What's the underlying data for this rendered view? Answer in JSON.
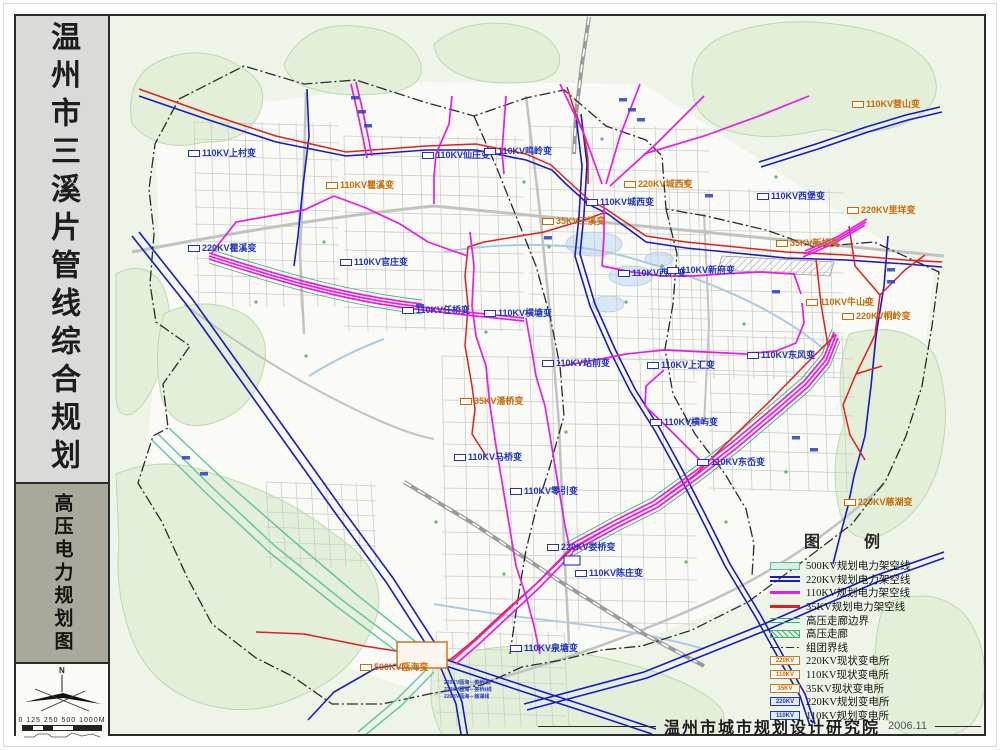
{
  "sidebar": {
    "main_title": "温州市三溪片管线综合规划",
    "sub_title": "高压电力规划图",
    "compass_label": "N",
    "scale_text": "0 125 250 500    1000M"
  },
  "legend": {
    "title": "图　例",
    "items": [
      {
        "label": "500KV规划电力架空线",
        "swatch": "band500"
      },
      {
        "label": "220KV规划电力架空线",
        "swatch": "line220"
      },
      {
        "label": "110KV规划电力架空线",
        "swatch": "line110"
      },
      {
        "label": "35KV规划电力架空线",
        "swatch": "line35"
      },
      {
        "label": "高压走廊边界",
        "swatch": "corridor-edge"
      },
      {
        "label": "高压走廊",
        "swatch": "corridor"
      },
      {
        "label": "组团界线",
        "swatch": "cluster-boundary"
      },
      {
        "label": "220KV现状变电所",
        "swatch": "box-existing",
        "box_text": "220KV"
      },
      {
        "label": "110KV现状变电所",
        "swatch": "box-existing",
        "box_text": "110KV"
      },
      {
        "label": "35KV现状变电所",
        "swatch": "box-existing",
        "box_text": "35KV"
      },
      {
        "label": "220KV规划变电所",
        "swatch": "box-planned",
        "box_text": "220KV"
      },
      {
        "label": "110KV规划变电所",
        "swatch": "box-planned",
        "box_text": "110KV"
      }
    ]
  },
  "footer": {
    "org": "温州市城市规划设计研究院",
    "date": "2006.11"
  },
  "colors": {
    "kv500": "#63c7a4",
    "kv220": "#1a1ac8",
    "kv110": "#e81ce8",
    "kv35": "#e02020",
    "corridor_edge": "#3bb26d",
    "existing_text": "#cc6600",
    "planned_text": "#2134c4"
  },
  "map": {
    "substations": [
      {
        "label": "110KV瞿溪变",
        "x": 322,
        "y": 180,
        "type": "existing"
      },
      {
        "label": "35KV三溪变",
        "x": 538,
        "y": 216,
        "type": "existing"
      },
      {
        "label": "220KV城西变",
        "x": 620,
        "y": 179,
        "type": "existing"
      },
      {
        "label": "110KV营山变",
        "x": 848,
        "y": 99,
        "type": "existing"
      },
      {
        "label": "220KV里垟变",
        "x": 843,
        "y": 205,
        "type": "existing"
      },
      {
        "label": "35KV新桥变",
        "x": 772,
        "y": 238,
        "type": "existing"
      },
      {
        "label": "110KV牛山变",
        "x": 802,
        "y": 297,
        "type": "existing"
      },
      {
        "label": "220KV桐岭变",
        "x": 838,
        "y": 311,
        "type": "existing"
      },
      {
        "label": "35KV潘桥变",
        "x": 456,
        "y": 396,
        "type": "existing"
      },
      {
        "label": "220KV慈湖变",
        "x": 840,
        "y": 497,
        "type": "existing"
      },
      {
        "label": "500KV瓯海变",
        "x": 356,
        "y": 662,
        "type": "existing"
      },
      {
        "label": "110KV上村变",
        "x": 184,
        "y": 148,
        "type": "planned"
      },
      {
        "label": "110KV仙庄变",
        "x": 418,
        "y": 150,
        "type": "planned"
      },
      {
        "label": "110KV鸣岭变",
        "x": 480,
        "y": 146,
        "type": "planned"
      },
      {
        "label": "220KV瞿溪变",
        "x": 184,
        "y": 243,
        "type": "planned"
      },
      {
        "label": "110KV官庄变",
        "x": 336,
        "y": 257,
        "type": "planned"
      },
      {
        "label": "110KV城西变",
        "x": 582,
        "y": 197,
        "type": "planned"
      },
      {
        "label": "110KV西村变",
        "x": 614,
        "y": 268,
        "type": "planned"
      },
      {
        "label": "110KV新府变",
        "x": 663,
        "y": 265,
        "type": "planned"
      },
      {
        "label": "110KV西堡变",
        "x": 753,
        "y": 191,
        "type": "planned"
      },
      {
        "label": "110KV任桥变",
        "x": 398,
        "y": 305,
        "type": "planned"
      },
      {
        "label": "110KV横塘变",
        "x": 480,
        "y": 308,
        "type": "planned"
      },
      {
        "label": "110KV站前变",
        "x": 538,
        "y": 358,
        "type": "planned"
      },
      {
        "label": "110KV上汇变",
        "x": 643,
        "y": 360,
        "type": "planned"
      },
      {
        "label": "110KV东风变",
        "x": 743,
        "y": 350,
        "type": "planned"
      },
      {
        "label": "110KV横屿变",
        "x": 646,
        "y": 417,
        "type": "planned"
      },
      {
        "label": "110KV东岙变",
        "x": 693,
        "y": 457,
        "type": "planned"
      },
      {
        "label": "110KV马桥变",
        "x": 450,
        "y": 452,
        "type": "planned"
      },
      {
        "label": "110KV零引变",
        "x": 506,
        "y": 486,
        "type": "planned"
      },
      {
        "label": "220KV娄桥变",
        "x": 543,
        "y": 542,
        "type": "planned"
      },
      {
        "label": "110KV陈庄变",
        "x": 571,
        "y": 568,
        "type": "planned"
      },
      {
        "label": "110KV泉塘变",
        "x": 506,
        "y": 643,
        "type": "planned"
      }
    ],
    "line_labels": [
      {
        "text": "220KV瓯海－娄桥Ⅰ线",
        "x": 440,
        "y": 676
      },
      {
        "text": "220KV瓯海－娄桥Ⅱ线",
        "x": 440,
        "y": 683
      },
      {
        "text": "220KV瓯海－慈湖线",
        "x": 440,
        "y": 690
      }
    ]
  }
}
